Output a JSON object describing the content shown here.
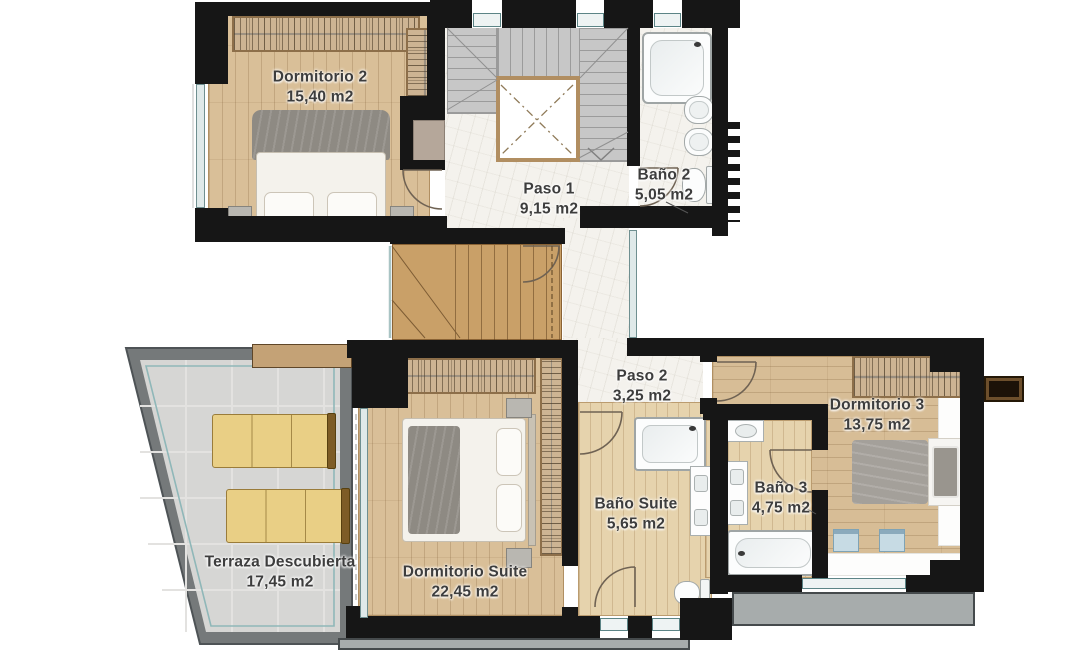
{
  "plan_title": "Second floor plan",
  "rooms": {
    "dormitorio2": {
      "name": "Dormitorio 2",
      "area": "15,40 m2"
    },
    "paso1": {
      "name": "Paso 1",
      "area": "9,15 m2"
    },
    "bano2": {
      "name": "Baño 2",
      "area": "5,05 m2"
    },
    "paso2": {
      "name": "Paso 2",
      "area": "3,25 m2"
    },
    "terraza": {
      "name": "Terraza Descubierta",
      "area": "17,45 m2"
    },
    "dormitorioSuite": {
      "name": "Dormitorio Suite",
      "area": "22,45 m2"
    },
    "banoSuite": {
      "name": "Baño Suite",
      "area": "5,65 m2"
    },
    "bano3": {
      "name": "Baño 3",
      "area": "4,75 m2"
    },
    "dormitorio3": {
      "name": "Dormitorio 3",
      "area": "13,75 m2"
    }
  },
  "colors": {
    "wall": "#161616",
    "wood_floor": "#d9bf98",
    "light_wood_floor": "#e6d3ad",
    "tile_floor": "#f4f2ed",
    "terrace_tile": "#d6d6d4",
    "terrace_parapet": "#75797a",
    "lounger_yellow": "#e9cf85",
    "stair_concrete": "#c7c7c7",
    "stair_wood": "#c9a068",
    "glass": "#dfe9e9",
    "balcony_slab": "#a7acac",
    "label_text": "#3d3d3d"
  }
}
